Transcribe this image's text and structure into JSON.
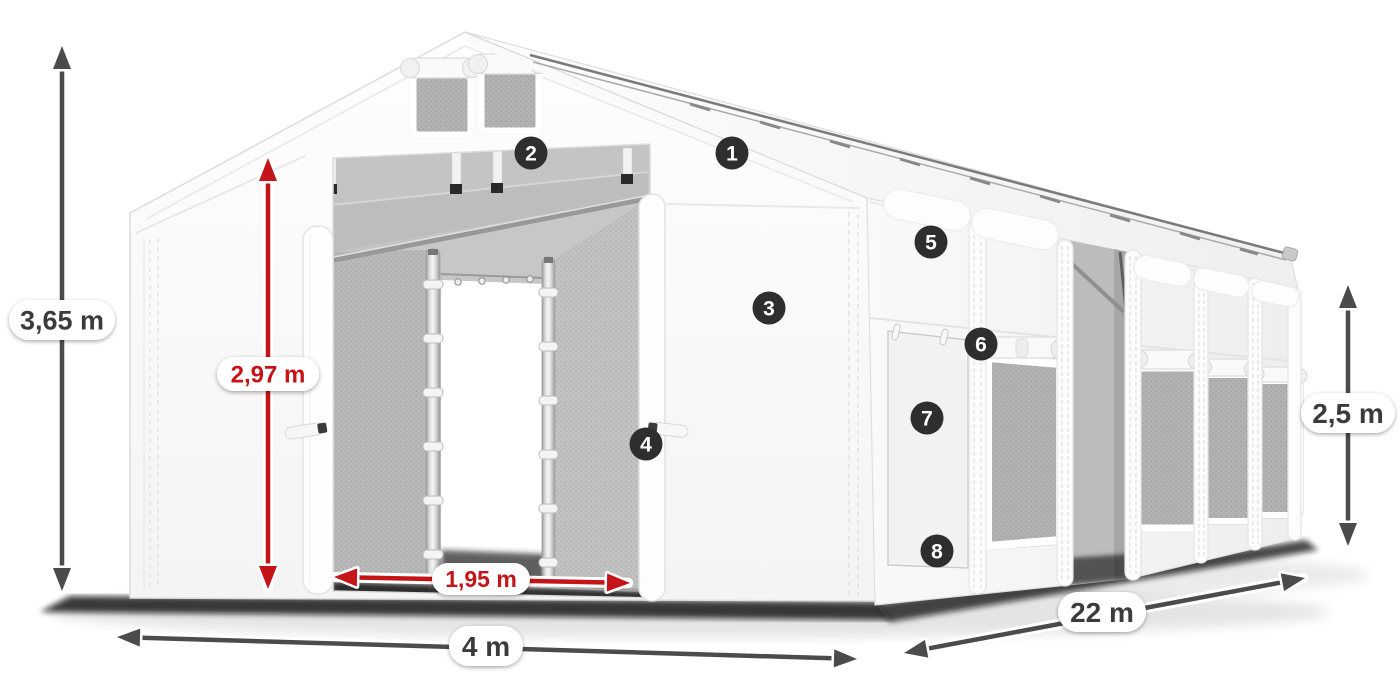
{
  "diagram": {
    "type": "tent-product-callout-diagram",
    "background": "#ffffff",
    "colors": {
      "dark_arrow": "#4b4b4b",
      "red_arrow": "#c41418",
      "pill_bg": "#ffffff",
      "pill_text_dark": "#3b3b3b",
      "marker_bg": "#2e2e2e",
      "marker_text": "#ffffff"
    },
    "markers": [
      {
        "number": "1",
        "x": 732,
        "y": 153
      },
      {
        "number": "2",
        "x": 531,
        "y": 153
      },
      {
        "number": "3",
        "x": 769,
        "y": 308
      },
      {
        "number": "4",
        "x": 646,
        "y": 444
      },
      {
        "number": "5",
        "x": 931,
        "y": 242
      },
      {
        "number": "6",
        "x": 981,
        "y": 344
      },
      {
        "number": "7",
        "x": 927,
        "y": 418
      },
      {
        "number": "8",
        "x": 937,
        "y": 551
      }
    ],
    "dimensions": [
      {
        "id": "total-height",
        "label": "3,65 m",
        "kind": "dark",
        "x1": 62,
        "y1": 46,
        "x2": 62,
        "y2": 591,
        "lx": 62,
        "ly": 320,
        "pw": 106,
        "ph": 40,
        "fs": 27
      },
      {
        "id": "ridge-height",
        "label": "2,97 m",
        "kind": "red",
        "x1": 268,
        "y1": 158,
        "x2": 268,
        "y2": 589,
        "lx": 268,
        "ly": 374,
        "pw": 102,
        "ph": 34,
        "fs": 24
      },
      {
        "id": "entrance-width",
        "label": "1,95 m",
        "kind": "red",
        "x1": 334,
        "y1": 577,
        "x2": 630,
        "y2": 583,
        "lx": 481,
        "ly": 579,
        "pw": 98,
        "ph": 32,
        "fs": 23
      },
      {
        "id": "front-width",
        "label": "4 m",
        "kind": "dark",
        "x1": 117,
        "y1": 637,
        "x2": 857,
        "y2": 659,
        "lx": 486,
        "ly": 646,
        "pw": 74,
        "ph": 40,
        "fs": 28
      },
      {
        "id": "length",
        "label": "22 m",
        "kind": "dark",
        "x1": 904,
        "y1": 653,
        "x2": 1305,
        "y2": 578,
        "lx": 1102,
        "ly": 612,
        "pw": 88,
        "ph": 40,
        "fs": 28
      },
      {
        "id": "side-height",
        "label": "2,5 m",
        "kind": "dark",
        "x1": 1348,
        "y1": 285,
        "x2": 1348,
        "y2": 546,
        "lx": 1348,
        "ly": 413,
        "pw": 94,
        "ph": 40,
        "fs": 28
      }
    ]
  }
}
